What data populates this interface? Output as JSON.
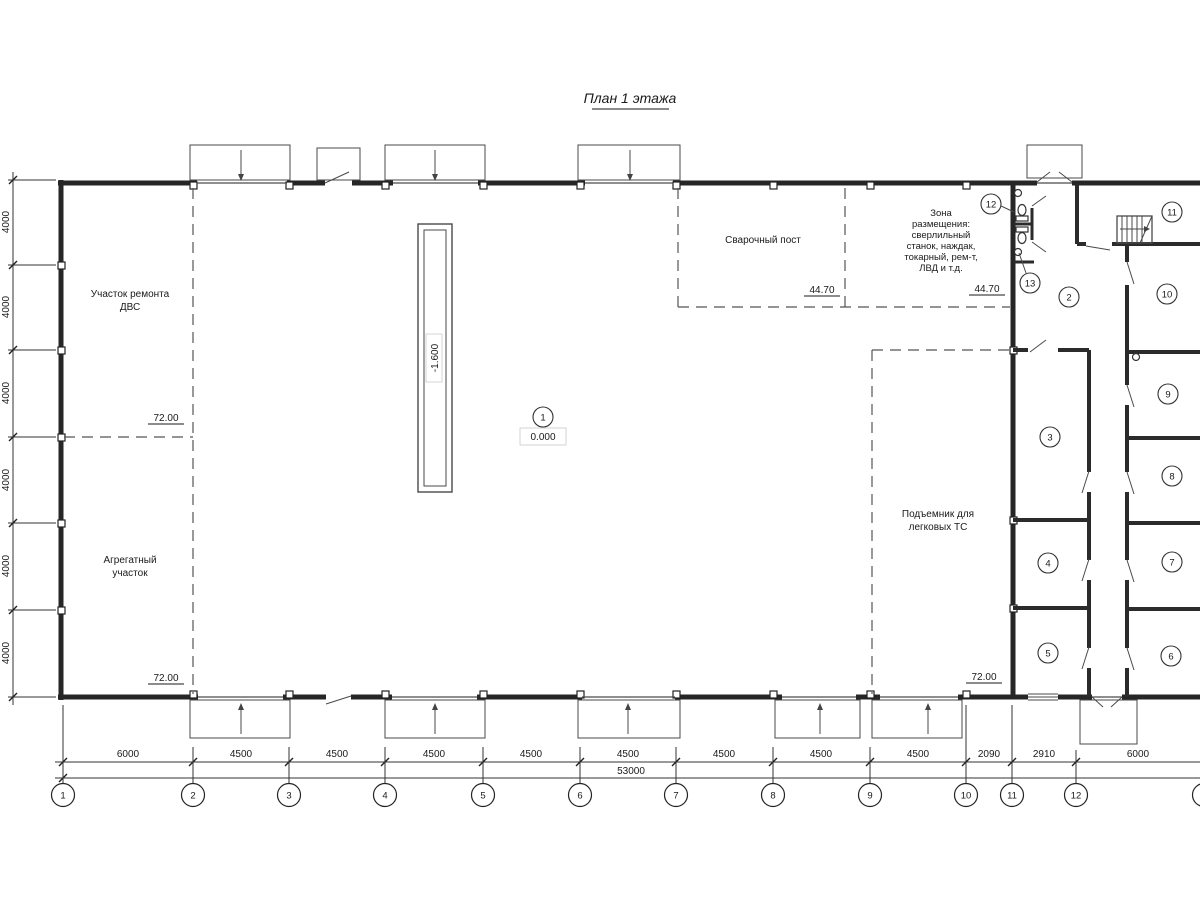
{
  "title": "План 1 этажа",
  "labels": {
    "dvs1": "Участок ремонта",
    "dvs2": "ДВС",
    "agg1": "Агрегатный",
    "agg2": "участок",
    "weld": "Сварочный пост",
    "zone": [
      "Зона",
      "размещения:",
      "сверлильный",
      "станок, наждак,",
      "токарный, рем-т,",
      "ЛВД и т.д."
    ],
    "lift1": "Подъемник для",
    "lift2": "легковых ТС"
  },
  "elevations": {
    "dvs": "72.00",
    "agg": "72.00",
    "lift": "72.00",
    "weld": "44.70",
    "zone": "44.70",
    "hall": "0.000",
    "pit": "-1.600"
  },
  "room_markers": [
    "1",
    "2",
    "3",
    "4",
    "5",
    "6",
    "7",
    "8",
    "9",
    "10",
    "11",
    "12",
    "13"
  ],
  "grid_bubbles": [
    "1",
    "2",
    "3",
    "4",
    "5",
    "6",
    "7",
    "8",
    "9",
    "10",
    "11",
    "12"
  ],
  "dims": {
    "bottom": [
      "6000",
      "4500",
      "4500",
      "4500",
      "4500",
      "4500",
      "4500",
      "4500",
      "4500",
      "2090",
      "2910",
      "6000"
    ],
    "total": "53000",
    "left": [
      "4000",
      "4000",
      "4000",
      "4000",
      "4000",
      "4000"
    ]
  }
}
